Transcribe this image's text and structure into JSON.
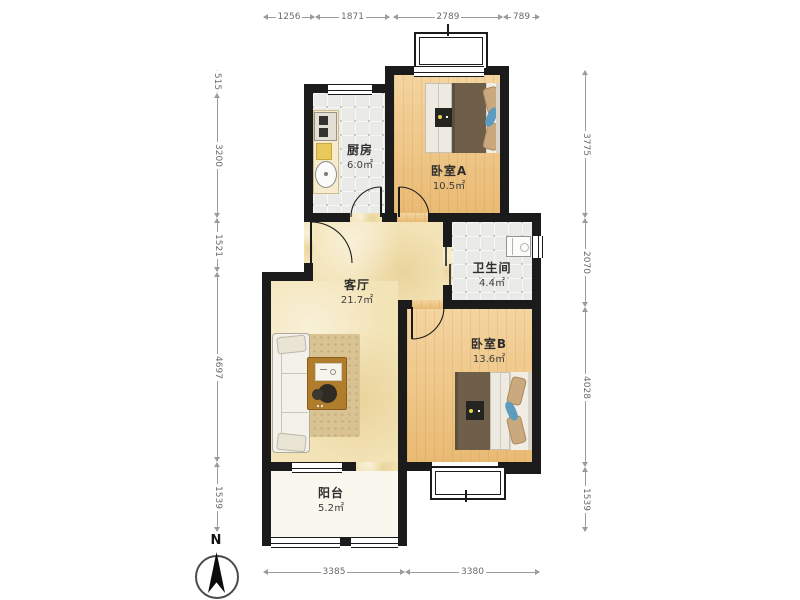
{
  "plan": {
    "rooms": [
      {
        "name": "厨房",
        "area": "6.0㎡"
      },
      {
        "name": "卧室A",
        "area": "10.5㎡"
      },
      {
        "name": "卫生间",
        "area": "4.4㎡"
      },
      {
        "name": "客厅",
        "area": "21.7㎡"
      },
      {
        "name": "卧室B",
        "area": "13.6㎡"
      },
      {
        "name": "阳台",
        "area": "5.2㎡"
      }
    ],
    "dimensions_mm": {
      "top": [
        "1256",
        "1871",
        "2789",
        "789"
      ],
      "left": [
        "515",
        "3200",
        "1521",
        "4697",
        "1539"
      ],
      "right": [
        "3775",
        "2070",
        "4028",
        "1539"
      ],
      "bottom": [
        "3385",
        "3380"
      ]
    },
    "compass": {
      "label": "N"
    },
    "colors": {
      "wall": "#1b1b1b",
      "bedroom_floor": "#eec27f",
      "living_floor": "#f3e4b8",
      "tile_floor": "#eaeae8",
      "balcony_floor": "#faf7ee",
      "dimension_text": "#6a6a6a"
    }
  }
}
